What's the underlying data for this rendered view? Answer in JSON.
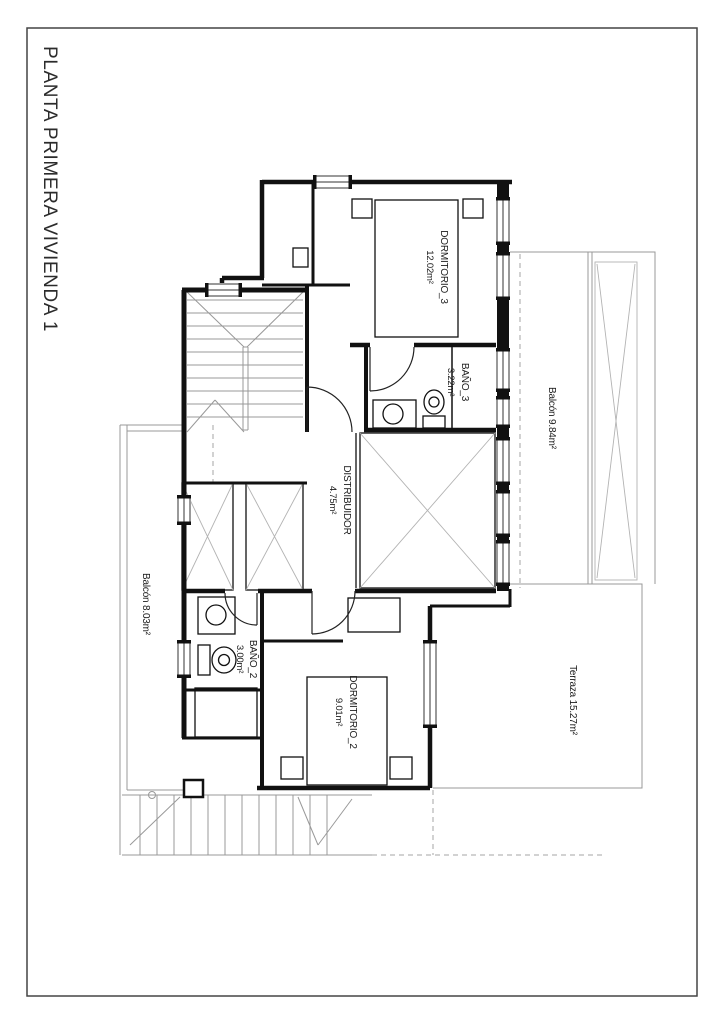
{
  "page": {
    "title": "PLANTA PRIMERA VIVIENDA 1"
  },
  "plan": {
    "rooms": [
      {
        "id": "dormitorio-3",
        "label_lines": [
          "DORMITORIO_3",
          "12.02m²"
        ]
      },
      {
        "id": "bano-3",
        "label_lines": [
          "BAÑO_3",
          "3.22m²"
        ]
      },
      {
        "id": "balcon-right",
        "label_lines": [
          "Balcón 9.84m²"
        ]
      },
      {
        "id": "distribuidor",
        "label_lines": [
          "DISTRIBUIDOR",
          "4.75m²"
        ]
      },
      {
        "id": "balcon-left",
        "label_lines": [
          "Balcón 8.03m²"
        ]
      },
      {
        "id": "bano-2",
        "label_lines": [
          "BAÑO_2",
          "3.00m²"
        ]
      },
      {
        "id": "dormitorio-2",
        "label_lines": [
          "DORMITORIO_2",
          "9.01m²"
        ]
      },
      {
        "id": "terraza",
        "label_lines": [
          "Terraza 15.27m²"
        ]
      }
    ]
  },
  "colors": {
    "paper": "#ffffff",
    "frame_border": "#444444",
    "wall": "#111111",
    "light_line": "#999999",
    "hatch_line": "#b3b3b3",
    "text": "#1a1a1a"
  }
}
